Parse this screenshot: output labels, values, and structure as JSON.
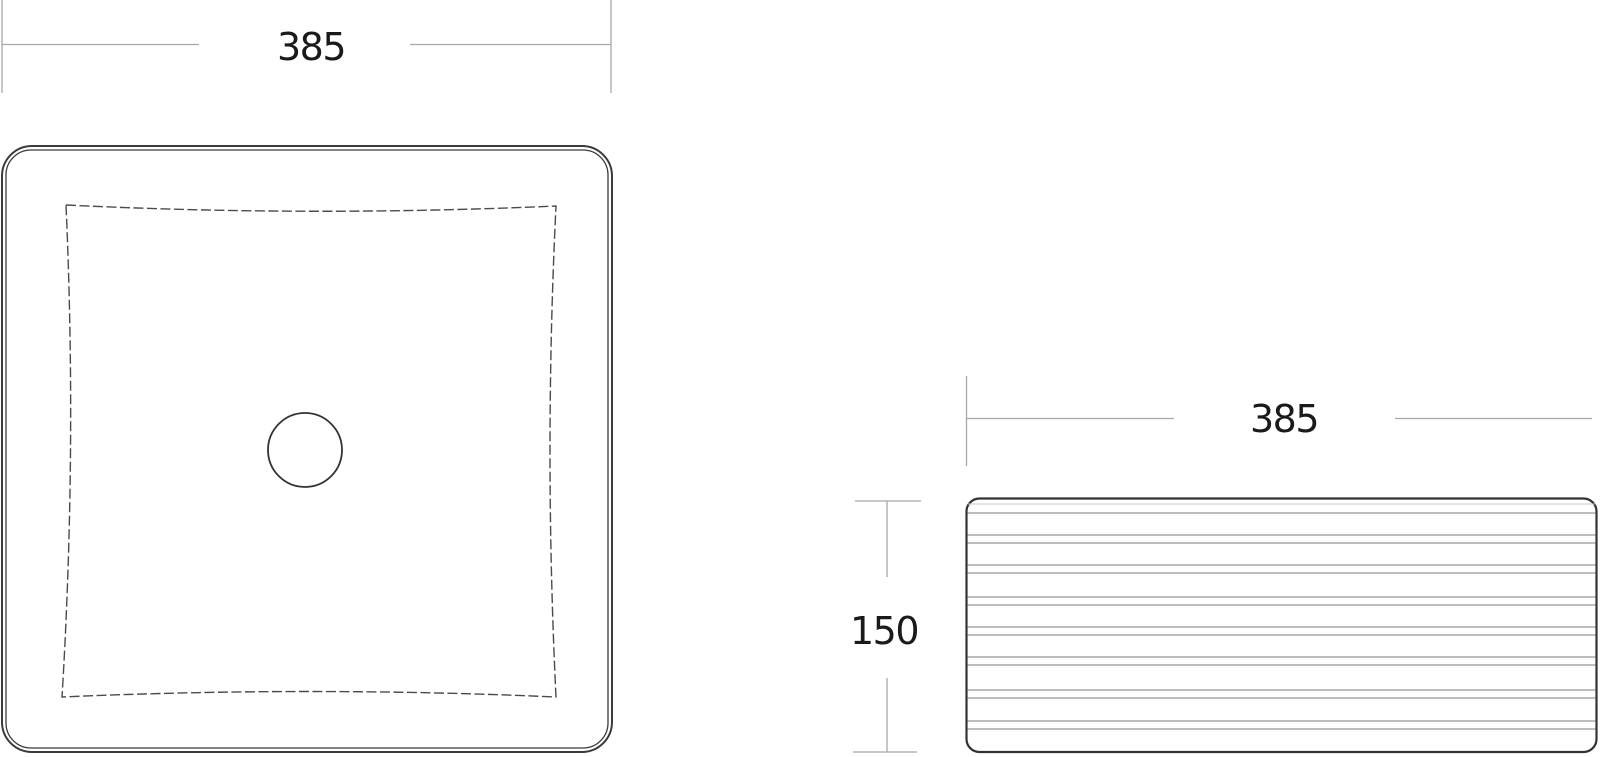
{
  "drawing": {
    "background": "#ffffff",
    "top_view": {
      "name": "basin-top-view",
      "width_dimension": {
        "label": "385"
      }
    },
    "side_view": {
      "name": "basin-side-view",
      "width_dimension": {
        "label": "385"
      },
      "height_dimension": {
        "label": "150"
      }
    },
    "colors": {
      "outline": "#3b3b3b",
      "basin_dashed_outline": "#4b4b4b",
      "flute_lines": "#969696",
      "dimension_lines": "#a8a8a8",
      "dimension_text": "#1a1a1a"
    }
  }
}
